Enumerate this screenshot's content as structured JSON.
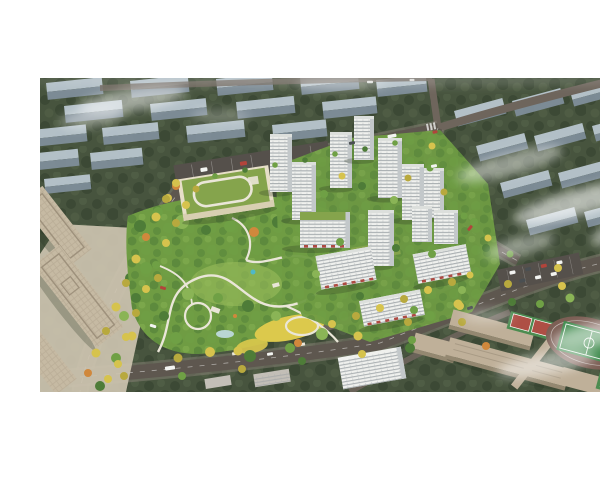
{
  "meta": {
    "title": "Aerial architectural rendering — residential community masterplan with central park",
    "type": "photorealistic 3D bird's-eye render, letterboxed on white"
  },
  "scene": {
    "regions": [
      "faded background city blocks in trees (upper left and right)",
      "arterial roads lined with autumn-yellow trees",
      "central landscaped park with winding white paths and yellow meadow",
      "kindergarten with green roof and white rooftop loop track",
      "white residential high-rise towers and mid-rise slabs with street retail",
      "beige office blocks and plaza (lower left)",
      "school campus with red courts and green sports field with running track (lower right)",
      "drifting white fog patches"
    ]
  },
  "palette": {
    "page_bg": "#ffffff",
    "bg_tree": "#47543e",
    "bg_tree_dark": "#3a4733",
    "bg_tree_light": "#57664b",
    "bg_bldg_top": "#b9c6cf",
    "bg_bldg_side": "#7f8e9a",
    "road": "#5e574f",
    "road_minor": "#6e655c",
    "road_edge": "#8a8178",
    "park_base": "#6f9c43",
    "park_light": "#9abd5c",
    "meadow": "#dcc94c",
    "path": "#eae6d8",
    "water": "#b9d6d4",
    "tower_face": "#f0f1ee",
    "tower_side": "#c3c8ca",
    "tower_roof": "#dcdfdc",
    "tower_line": "#8f979c",
    "podium_green": "#85a44c",
    "kindergarten_wall": "#e7dfc8",
    "kindergarten_band": "#d8cfb2",
    "retail_red": "#ae4a42",
    "office_tan": "#c6baa3",
    "office_roofline": "#9e917c",
    "plaza": "#cdc4b0",
    "campus_tan": "#bfb099",
    "campus_side": "#948871",
    "field_green": "#418c4f",
    "track_surface": "#7c5f55",
    "court_red": "#ae4f45",
    "court_green": "#4c8c50",
    "parking": "#55504b",
    "context_grey": "#c3bfb7",
    "mist": "#ffffff",
    "tree_green1": "#4e7c38",
    "tree_green2": "#6fa045",
    "tree_green3": "#8ab456",
    "autumn_yellow1": "#d6c34d",
    "autumn_yellow2": "#b8a93e",
    "autumn_orange": "#d0883c",
    "car_white": "#f3f4f1",
    "car_red": "#b2443b",
    "car_dark": "#4a4f52"
  }
}
